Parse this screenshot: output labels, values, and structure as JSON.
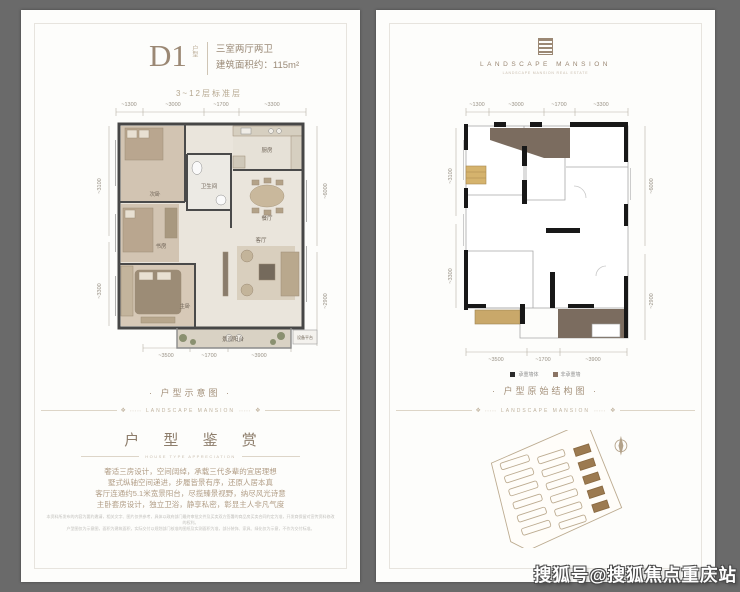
{
  "watermark": "搜狐号@搜狐焦点重庆站",
  "colors": {
    "canvas_bg": "#6a6a6a",
    "card_bg": "#fdfdfb",
    "accent_taupe": "#8d7d6b",
    "wall_dark": "#181818",
    "fill_brown": "#7b6c5f",
    "fill_tan": "#d5b36d"
  },
  "left_panel": {
    "header": {
      "code": "D1",
      "code_note": "户型",
      "summary": "三室两厅两卫",
      "area": "建筑面积约：115m²",
      "floor_range": "3~12层标准层"
    },
    "plan": {
      "dims_top": [
        "~1300",
        "~3000",
        "~1700",
        "~3300"
      ],
      "dims_bottom": [
        "~3500",
        "~1700",
        "~3900"
      ],
      "dims_left": [
        "~3100",
        "~3300"
      ],
      "dims_right": [
        "~6000",
        "~2900"
      ],
      "rooms": {
        "bedroom2": "次卧",
        "study": "书房",
        "master": "主卧",
        "bath": "卫生间",
        "kitchen": "厨房",
        "dining": "餐厅",
        "living": "客厅",
        "balcony": "景观阳台",
        "equipment": "设备平台"
      }
    },
    "caption": "· 户型示意图 ·",
    "band_text": "LANDSCAPE MANSION",
    "appreciation": {
      "title": "户 型 鉴 赏",
      "subtitle": "HOUSE TYPE APPRECIATION",
      "lines": [
        "奢适三房设计，空间阔绰，承载三代多辈的宜居理想",
        "墅式纵轴空间递进，步履皆景有序，还原人居本真",
        "客厅连通约5.1米宽景阳台，尽揽臻景视野，纳尽风光诗意",
        "主卧套房设计，独立卫浴，静享私密，彰显主人非凡气度"
      ]
    },
    "disclaimer": [
      "本资料所发布的内容为要约邀请，相关文字、图片仅供参考，具体以政府部门最终审批文件及买卖双方签署的商品房买卖合同约定为准，开发商保留对宣传资料修改的权利。",
      "户型图仅为示意图，面积为建筑面积，实际交付以规划部门核准的图纸及实测面积为准，部分装饰、家具、绿化仅为示意，不作为交付标准。"
    ]
  },
  "right_panel": {
    "brand": {
      "name": "LANDSCAPE MANSION",
      "tagline": "LANDSCAPE MANSION REAL ESTATE"
    },
    "plan": {
      "dims_top": [
        "~1300",
        "~3000",
        "~1700",
        "~3300"
      ],
      "dims_bottom": [
        "~3500",
        "~1700",
        "~3900"
      ],
      "dims_left": [
        "~3100",
        "~3300"
      ],
      "dims_right": [
        "~6000",
        "~2900"
      ]
    },
    "legend": [
      {
        "label": "承重墙体",
        "color": "#2b2b2b"
      },
      {
        "label": "非承重墙",
        "color": "#8a7464"
      }
    ],
    "caption": "· 户型原始结构图 ·",
    "band_text": "LANDSCAPE MANSION"
  }
}
